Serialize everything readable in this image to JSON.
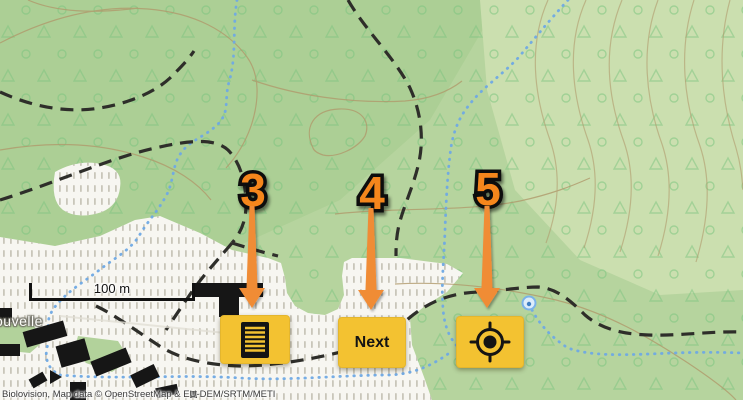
{
  "map": {
    "scale_bar_label": "100 m",
    "place_label": "ouvelle",
    "attribution": "Biolovision, Map data © OpenStreetMap & EU-DEM/SRTM/METI",
    "colors": {
      "forest_green": "#b6d49e",
      "forest_green_dark": "#accf95",
      "hillside_light": "#cbdfaf",
      "clearing_white": "#f7f6f1",
      "contour_brown": "#b09a6c",
      "stream_blue": "#6fa9e4",
      "trail_black": "#2e2e2a",
      "building_black": "#161616"
    }
  },
  "tutorial": {
    "steps": [
      {
        "number": "3",
        "target": "list-button"
      },
      {
        "number": "4",
        "target": "next-button"
      },
      {
        "number": "5",
        "target": "locate-button"
      }
    ],
    "number_color": "#f5861b",
    "arrow_color": "#f08c36",
    "outline_color": "#0d0d0d"
  },
  "controls": {
    "list_button": {
      "icon": "list-icon"
    },
    "next_button": {
      "label": "Next"
    },
    "locate_button": {
      "icon": "crosshair-locate-icon"
    },
    "button_color": "#f3c231"
  }
}
